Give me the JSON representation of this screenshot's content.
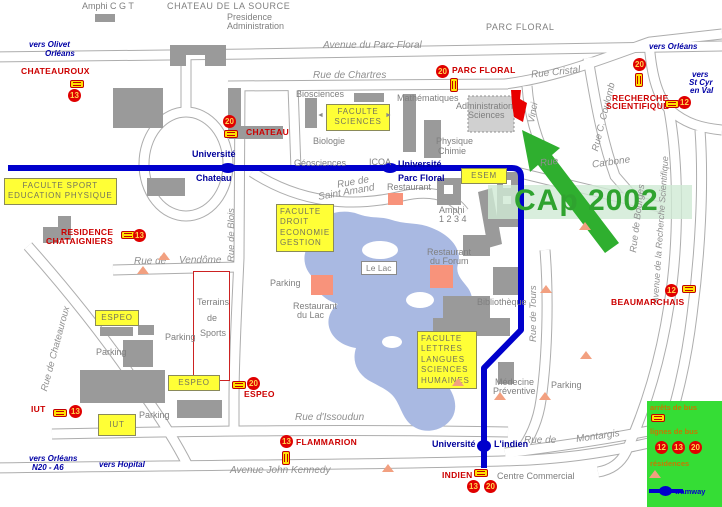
{
  "overlay": {
    "conference": "CAp 2002"
  },
  "icons": {
    "arrow_left": "◄",
    "arrow_right": "►"
  },
  "legend": {
    "bus_stop_label": "arrêts de bus",
    "bus_lines_label": "lignes de bus",
    "bus_lines": [
      "12",
      "13",
      "20"
    ],
    "residences_label": "résidences",
    "tram_label": "tramway"
  },
  "directions": {
    "olivet_1": "vers Olivet",
    "olivet_2": "Orléans",
    "orleans_ne": "vers Orléans",
    "stcyr_1": "vers",
    "stcyr_2": "St Cyr",
    "stcyr_3": "en Val",
    "orleans_sw_1": "vers Orléans",
    "orleans_sw_2": "N20 - A6",
    "hopital": "vers Hopital"
  },
  "streets": {
    "avenue_parc_floral": "Avenue du Parc Floral",
    "rue_de_chartres": "Rue de Chartres",
    "rue_cristal": "Rue Cristal",
    "rue_st_amand_1": "Rue de",
    "rue_st_amand_2": "Saint Amand",
    "rue_carbone_1": "Rue",
    "rue_carbone_2": "Carbone",
    "rue_de_vendome_1": "Rue de",
    "rue_de_vendome_2": "Vendôme",
    "rue_d_issoudun": "Rue d'Issoudun",
    "avenue_john_kennedy": "Avenue John Kennedy",
    "rue_de_montargis_1": "Rue de",
    "rue_de_montargis_2": "Montargis",
    "rue_de_blois": "Rue de Blois",
    "rue_de_chateauroux": "Rue de Chateauroux",
    "rue_de_tours": "Rue de Tours",
    "vinci": "Vinci",
    "rue_c_coulomb": "Rue C. Coulomb",
    "rue_de_bourges": "Rue de Bourges",
    "avenue_recherche": "Avenue de la Recherche Scientifique"
  },
  "places": {
    "amphi_cgt": "Amphi C G T",
    "chateau_source": "CHATEAU DE LA SOURCE",
    "presidence": "Presidence",
    "administration": "Administration",
    "parc_floral": "PARC FLORAL",
    "biosciences": "Biosciences",
    "mathematiques": "Mathématiques",
    "admin_sciences_1": "Administration",
    "admin_sciences_2": "Sciences",
    "biologie": "Biologie",
    "physique": "Physique",
    "chimie": "Chimie",
    "geosciences": "Géosciences",
    "icoa": "ICOA",
    "restaurant": "Restaurant",
    "amphi_1": "Amphi",
    "amphi_2": "1 2 3 4",
    "restaurant_forum_1": "Restaurant",
    "restaurant_forum_2": "du Forum",
    "le_lac": "Le Lac",
    "restaurant_lac_1": "Restaurant",
    "restaurant_lac_2": "du Lac",
    "bibliotheque": "Bibliothèque",
    "medecine_1": "Médecine",
    "medecine_2": "Préventive",
    "centre_commercial": "Centre Commercial",
    "terrains_1": "Terrains",
    "terrains_2": "de",
    "terrains_3": "Sports",
    "parking": "Parking"
  },
  "faculties": {
    "sciences_1": "FACULTE",
    "sciences_2": "SCIENCES",
    "sport_1": "FACULTE SPORT",
    "sport_2": "EDUCATION PHYSIQUE",
    "droit_1": "FACULTE",
    "droit_2": "DROIT",
    "droit_3": "ECONOMIE",
    "droit_4": "GESTION",
    "esem": "ESEM",
    "lettres_1": "FACULTE",
    "lettres_2": "LETTRES",
    "lettres_3": "LANGUES",
    "lettres_4": "SCIENCES",
    "lettres_5": "HUMAINES",
    "espeo": "ESPEO",
    "iut": "IUT"
  },
  "bus_stops": {
    "chateauroux": {
      "name": "CHATEAUROUX",
      "line": "13"
    },
    "chateau": {
      "name": "CHATEAU",
      "line": "20"
    },
    "parc_floral": {
      "name": "PARC FLORAL",
      "line": "20"
    },
    "recherche_n": {
      "line": "20"
    },
    "recherche": {
      "name_1": "RECHERCHE",
      "name_2": "SCIENTIFIQUE",
      "line": "12"
    },
    "beaumarchais": {
      "name": "BEAUMARCHAIS",
      "line": "12"
    },
    "residence": {
      "name_1": "RESIDENCE",
      "name_2": "CHATAIGNIERS",
      "line": "13"
    },
    "espeo": {
      "name": "ESPEO",
      "line": "20"
    },
    "iut": {
      "name": "IUT",
      "line": "13"
    },
    "flammarion": {
      "name": "FLAMMARION",
      "line": "13"
    },
    "indien": {
      "name": "INDIEN",
      "line_a": "13",
      "line_b": "20"
    }
  },
  "tram_stops": {
    "chateau": {
      "top": "Université",
      "bottom": "Chateau"
    },
    "parc_floral": {
      "top": "Université",
      "bottom": "Parc Floral"
    },
    "indien": {
      "left": "Université",
      "right": "L'indien"
    }
  },
  "colors": {
    "tram_blue": "#0000CC",
    "bus_red": "#DD0000",
    "faculty_yellow": "#FFFF33",
    "lake_blue": "#A9B9E2",
    "legend_green": "#35DD35",
    "arrow_green": "#2FAF2F",
    "residence_salmon": "#F2A080",
    "venue_red": "#E80000"
  }
}
